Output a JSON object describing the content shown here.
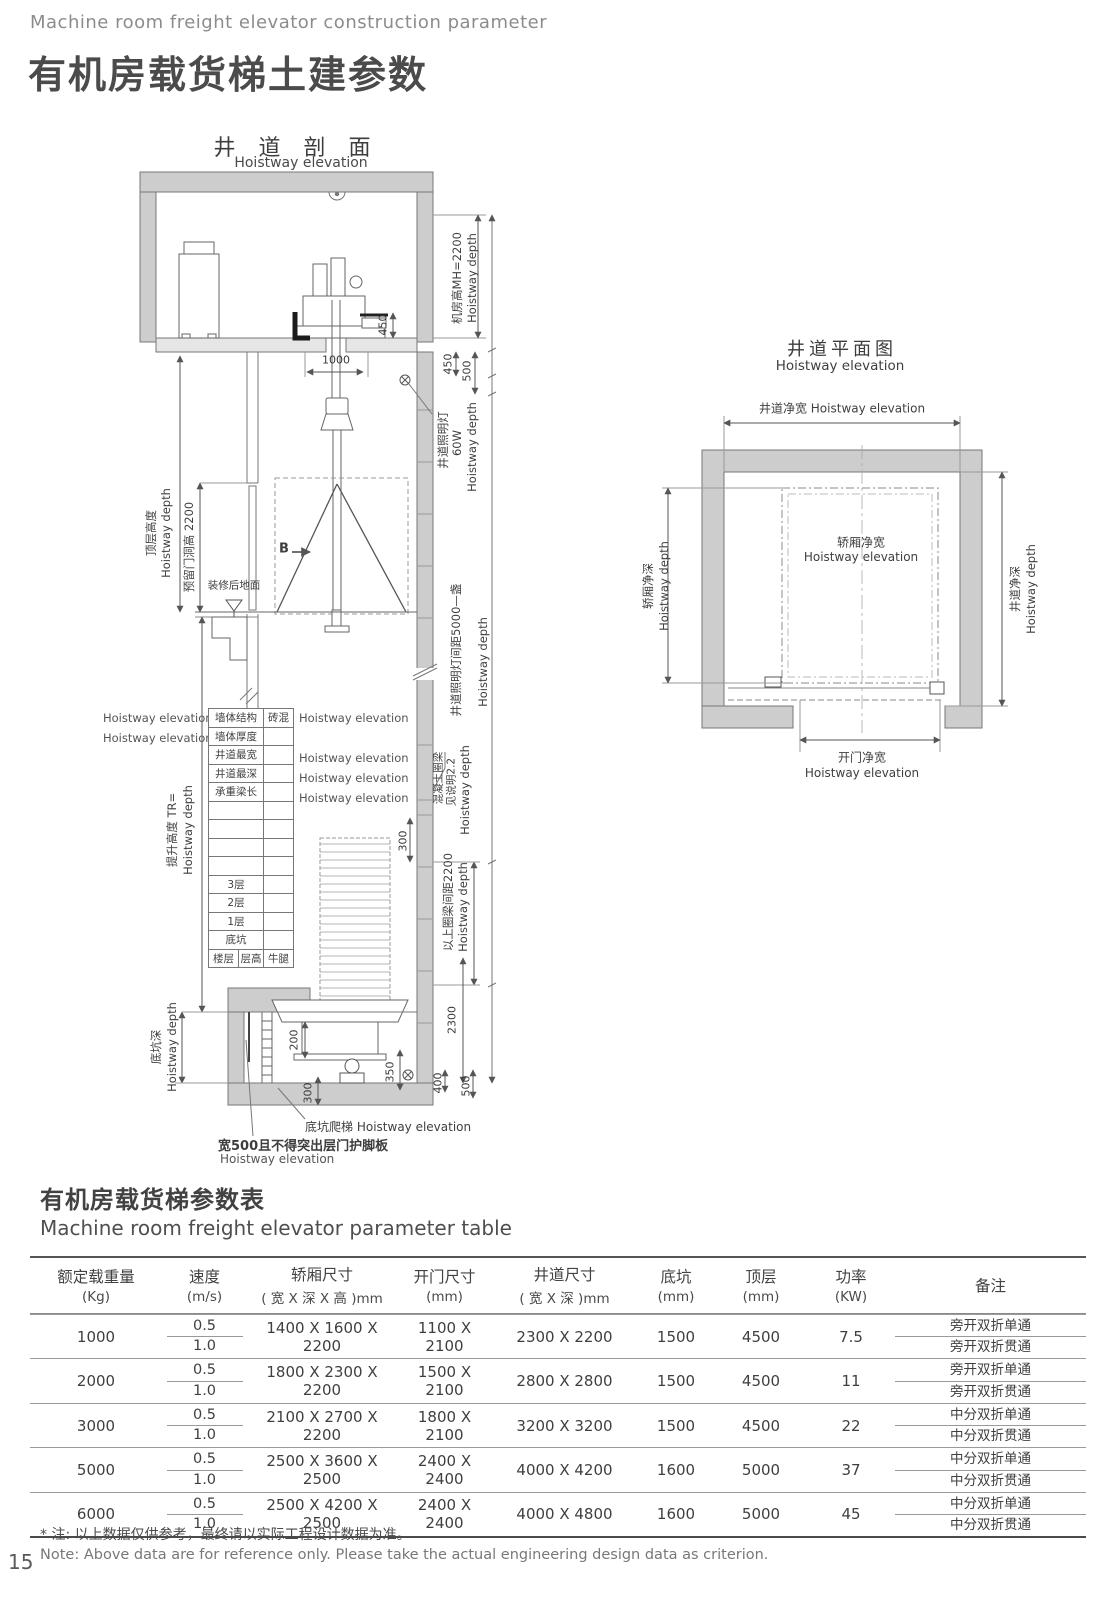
{
  "common": {
    "hoistway_depth": "Hoistway depth",
    "hoistway_elevation": "Hoistway elevation"
  },
  "header": {
    "subtitle_en": "Machine room freight elevator construction parameter",
    "title_zh": "有机房载货梯土建参数"
  },
  "section_view": {
    "title_zh": "井 道 剖 面",
    "title_en": "Hoistway elevation",
    "labels": {
      "machine_room_height": "机房高MH=2200",
      "shaft_light": "井道照明灯",
      "shaft_light_watt": "60W",
      "top_floor_height": "顶层高度",
      "door_opening_height": "预留门洞高 2200",
      "section_mark": "B",
      "finished_floor": "装修后地面",
      "travel_height": "提升高度 TR=",
      "light_spacing": "井道照明灯间距5000—盏",
      "concrete_ring_beam": "混凝土圈梁",
      "see_note": "见说明2.2",
      "beam_spacing": "以上圈梁间距2200",
      "pit_depth": "底坑深",
      "pit_ladder": "底坑爬梯",
      "toe_guard": "宽500且不得突出层门护脚板"
    },
    "dims": {
      "d450_top": "450",
      "d1000": "1000",
      "d450": "450",
      "d500": "500",
      "d300_beam": "300",
      "d2300": "2300",
      "d200": "200",
      "d300_pit": "300",
      "d350": "350",
      "d400": "400",
      "d500_pit": "500"
    },
    "mini_table": {
      "rows": [
        [
          "墙体结构",
          "砖混"
        ],
        [
          "墙体厚度",
          ""
        ],
        [
          "井道最宽",
          ""
        ],
        [
          "井道最深",
          ""
        ],
        [
          "承重梁长",
          ""
        ],
        [
          "",
          ""
        ],
        [
          "",
          ""
        ],
        [
          "",
          ""
        ],
        [
          "",
          ""
        ],
        [
          "3层",
          ""
        ],
        [
          "2层",
          ""
        ],
        [
          "1层",
          ""
        ],
        [
          "底坑",
          ""
        ]
      ],
      "footer": [
        "楼层",
        "层高",
        "牛腿"
      ]
    }
  },
  "plan_view": {
    "title_zh": "井道平面图",
    "title_en": "Hoistway elevation",
    "labels": {
      "shaft_net_width": "井道净宽",
      "car_net_width": "轿厢净宽",
      "car_net_depth": "轿厢净深",
      "shaft_net_depth": "井道净深",
      "door_net_width": "开门净宽"
    }
  },
  "param_table": {
    "title_zh": "有机房载货梯参数表",
    "title_en": "Machine room freight elevator parameter table",
    "headers": [
      [
        "额定载重量",
        "(Kg)"
      ],
      [
        "速度",
        "(m/s)"
      ],
      [
        "轿厢尺寸",
        "( 宽 X 深 X 高 )mm"
      ],
      [
        "开门尺寸",
        "(mm)"
      ],
      [
        "井道尺寸",
        "( 宽 X 深 )mm"
      ],
      [
        "底坑",
        "(mm)"
      ],
      [
        "顶层",
        "(mm)"
      ],
      [
        "功率",
        "(KW)"
      ],
      [
        "备注",
        ""
      ]
    ],
    "rows": [
      {
        "load": "1000",
        "speed_top": "0.5",
        "speed_bottom": "1.0",
        "car": "1400 X 1600 X 2200",
        "door": "1100 X 2100",
        "shaft": "2300 X 2200",
        "pit": "1500",
        "top": "4500",
        "power": "7.5",
        "remark_top": "旁开双折单通",
        "remark_bottom": "旁开双折贯通"
      },
      {
        "load": "2000",
        "speed_top": "0.5",
        "speed_bottom": "1.0",
        "car": "1800 X 2300 X 2200",
        "door": "1500 X 2100",
        "shaft": "2800 X 2800",
        "pit": "1500",
        "top": "4500",
        "power": "11",
        "remark_top": "旁开双折单通",
        "remark_bottom": "旁开双折贯通"
      },
      {
        "load": "3000",
        "speed_top": "0.5",
        "speed_bottom": "1.0",
        "car": "2100 X 2700 X 2200",
        "door": "1800 X 2100",
        "shaft": "3200 X 3200",
        "pit": "1500",
        "top": "4500",
        "power": "22",
        "remark_top": "中分双折单通",
        "remark_bottom": "中分双折贯通"
      },
      {
        "load": "5000",
        "speed_top": "0.5",
        "speed_bottom": "1.0",
        "car": "2500 X 3600 X 2500",
        "door": "2400 X 2400",
        "shaft": "4000 X 4200",
        "pit": "1600",
        "top": "5000",
        "power": "37",
        "remark_top": "中分双折单通",
        "remark_bottom": "中分双折贯通"
      },
      {
        "load": "6000",
        "speed_top": "0.5",
        "speed_bottom": "1.0",
        "car": "2500 X 4200 X 2500",
        "door": "2400 X 2400",
        "shaft": "4000 X 4800",
        "pit": "1600",
        "top": "5000",
        "power": "45",
        "remark_top": "中分双折单通",
        "remark_bottom": "中分双折贯通"
      }
    ],
    "note_zh": "* 注: 以上数据仅供参考，最终请以实际工程设计数据为准。",
    "note_en": "Note: Above data are for reference only. Please take the actual engineering design data as criterion.",
    "page_number": "15"
  }
}
